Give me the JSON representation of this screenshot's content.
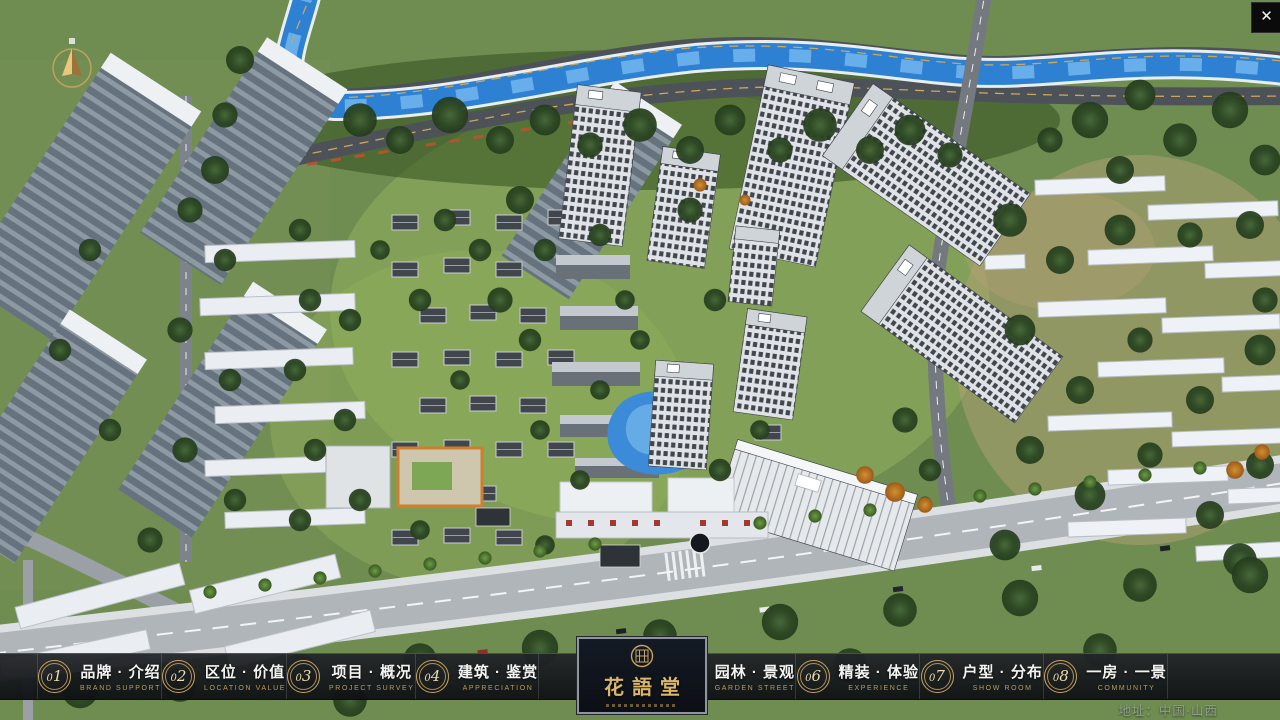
{
  "window": {
    "close_glyph": "✕"
  },
  "nav": {
    "items": [
      {
        "num": "01",
        "label": "品牌 · 介绍",
        "sub": "BRAND SUPPORT"
      },
      {
        "num": "02",
        "label": "区位 · 价值",
        "sub": "LOCATION VALUE"
      },
      {
        "num": "03",
        "label": "项目 · 概况",
        "sub": "PROJECT SURVEY"
      },
      {
        "num": "04",
        "label": "建筑 · 鉴赏",
        "sub": "APPRECIATION"
      },
      {
        "num": "05",
        "label": "园林 · 景观",
        "sub": "GARDEN STREET"
      },
      {
        "num": "06",
        "label": "精装 · 体验",
        "sub": "EXPERIENCE"
      },
      {
        "num": "07",
        "label": "户型 · 分布",
        "sub": "SHOW ROOM"
      },
      {
        "num": "08",
        "label": "一房 · 一景",
        "sub": "COMMUNITY"
      }
    ]
  },
  "logo": {
    "title": "花語堂"
  },
  "footer": {
    "address": "地址：中国·山西"
  },
  "colors": {
    "accent_gold": "#c9a35f",
    "nav_background": "#17191c",
    "logo_text": "#d9b66a",
    "river_blue": "#2e80d2",
    "lawn_green": "#8fae5b"
  }
}
